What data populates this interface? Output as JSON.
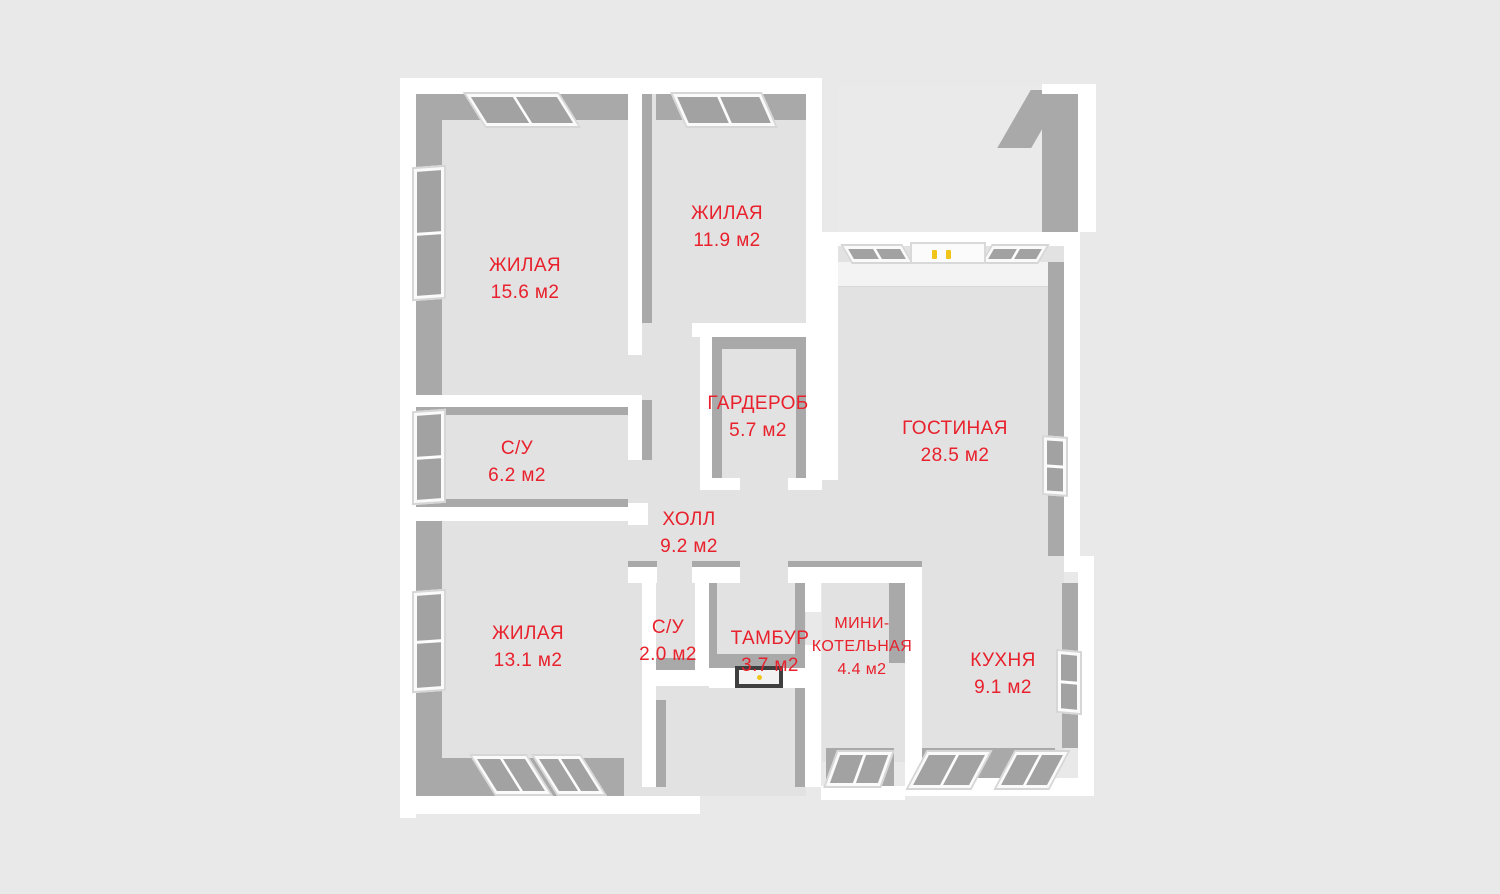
{
  "palette": {
    "background": "#e9e9e9",
    "floor": "#e2e2e2",
    "wall": "#ffffff",
    "wall_shadow": "#a9a9a9",
    "lit_face": "#f3f3f3",
    "label": "#e8212c",
    "handle_yellow": "#f0c419",
    "entrance_frame": "#3f3f3f"
  },
  "plan_type": "3d-floor-plan",
  "rooms": [
    {
      "id": "living-1",
      "name": "ЖИЛАЯ",
      "area": "15.6 м2"
    },
    {
      "id": "living-2",
      "name": "ЖИЛАЯ",
      "area": "11.9 м2"
    },
    {
      "id": "wardrobe",
      "name": "ГАРДЕРОБ",
      "area": "5.7 м2"
    },
    {
      "id": "living-room",
      "name": "ГОСТИНАЯ",
      "area": "28.5 м2"
    },
    {
      "id": "bathroom-1",
      "name": "С/У",
      "area": "6.2 м2"
    },
    {
      "id": "hall",
      "name": "ХОЛЛ",
      "area": "9.2 м2"
    },
    {
      "id": "living-3",
      "name": "ЖИЛАЯ",
      "area": "13.1 м2"
    },
    {
      "id": "bathroom-2",
      "name": "С/У",
      "area": "2.0 м2"
    },
    {
      "id": "vestibule",
      "name": "ТАМБУР",
      "area": "3.7 м2"
    },
    {
      "id": "mini-boiler",
      "name_lines": [
        "МИНИ-",
        "КОТЕЛЬНАЯ"
      ],
      "area": "4.4 м2"
    },
    {
      "id": "kitchen",
      "name": "КУХНЯ",
      "area": "9.1 м2"
    }
  ]
}
